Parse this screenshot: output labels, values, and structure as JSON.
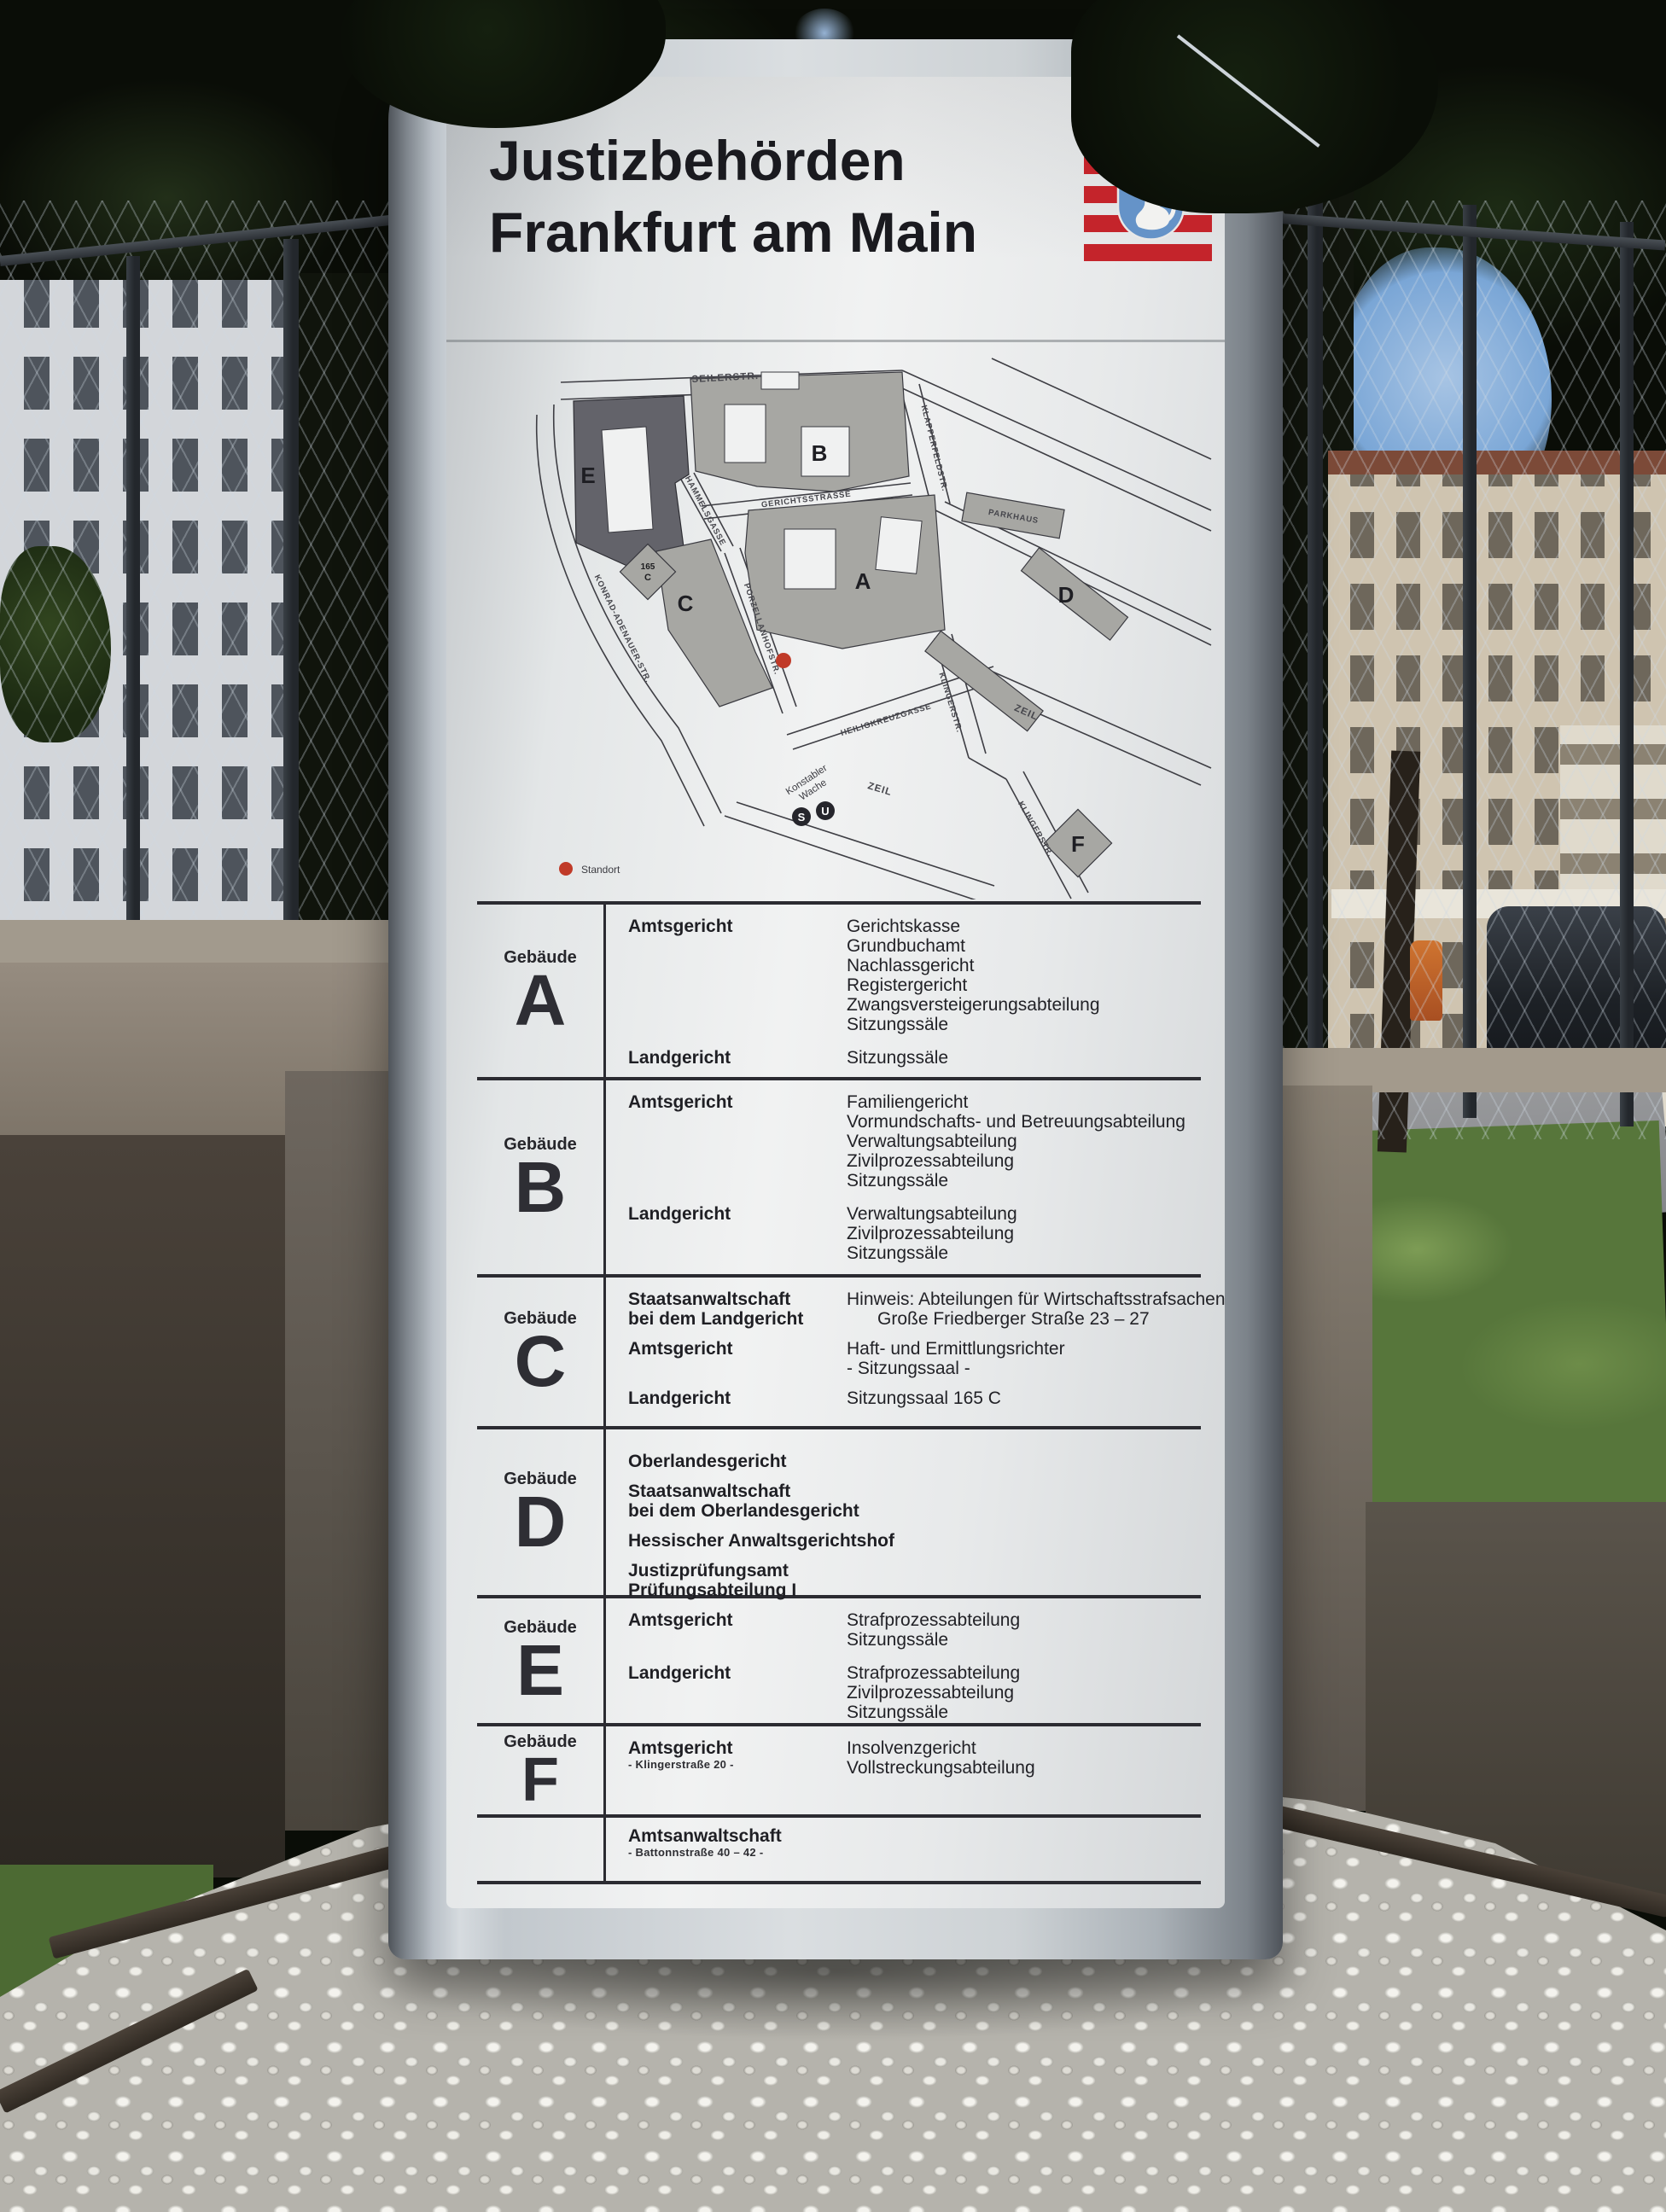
{
  "sign": {
    "title_line1": "Justizbehörden",
    "title_line2": "Frankfurt am Main",
    "hessen_label": "HESSEN",
    "colors": {
      "flag_red": "#c4242b",
      "shield_blue": "#6593c8"
    }
  },
  "map": {
    "streets": {
      "seilerstr": "SEILERSTR.",
      "klapperfeldstr": "KLAPPERFELDSTR.",
      "gerichtsstrasse": "GERICHTSSTRASSE",
      "hammelsgasse": "HAMMELSGASSE",
      "porzellanhofstr": "PORZELLANHOFSTR.",
      "konrad_adenauer_str": "KONRAD-ADENAUER-STR.",
      "heiligkreuzgasse": "HEILIGKREUZGASSE",
      "klingerstr_1": "KLINGERSTR.",
      "klingerstr_2": "KLINGERSTR.",
      "zeil_1": "ZEIL",
      "zeil_2": "ZEIL",
      "parkhaus": "PARKHAUS"
    },
    "buildings": {
      "a": "A",
      "b": "B",
      "c": "C",
      "d": "D",
      "e": "E",
      "f": "F",
      "c_annex_l1": "165",
      "c_annex_l2": "C"
    },
    "station": {
      "line1": "Konstabler",
      "line2": "Wache",
      "s": "S",
      "u": "U"
    },
    "legend": {
      "standort": "Standort"
    }
  },
  "directory": {
    "gebaeude_label": "Gebäude",
    "rows": [
      {
        "letter": "A",
        "sections": [
          {
            "org_lines": [
              "Amtsgericht"
            ],
            "items": [
              "Gerichtskasse",
              "Grundbuchamt",
              "Nachlassgericht",
              "Registergericht",
              "Zwangsversteigerungsabteilung",
              "Sitzungssäle"
            ]
          },
          {
            "org_lines": [
              "Landgericht"
            ],
            "items": [
              "Sitzungssäle"
            ]
          }
        ]
      },
      {
        "letter": "B",
        "sections": [
          {
            "org_lines": [
              "Amtsgericht"
            ],
            "items": [
              "Familiengericht",
              "Vormundschafts- und Betreuungsabteilung",
              "Verwaltungsabteilung",
              "Zivilprozessabteilung",
              "Sitzungssäle"
            ]
          },
          {
            "org_lines": [
              "Landgericht"
            ],
            "items": [
              "Verwaltungsabteilung",
              "Zivilprozessabteilung",
              "Sitzungssäle"
            ]
          }
        ]
      },
      {
        "letter": "C",
        "sections": [
          {
            "org_lines": [
              "Staatsanwaltschaft",
              "bei dem Landgericht"
            ],
            "items": [
              "Hinweis: Abteilungen für Wirtschaftsstrafsachen",
              "Große Friedberger Straße 23 – 27"
            ]
          },
          {
            "org_lines": [
              "Amtsgericht"
            ],
            "items": [
              "Haft- und Ermittlungsrichter",
              "- Sitzungssaal -"
            ]
          },
          {
            "org_lines": [
              "Landgericht"
            ],
            "items": [
              "Sitzungssaal 165 C"
            ]
          }
        ]
      },
      {
        "letter": "D",
        "sections": [
          {
            "org_lines": [
              "Oberlandesgericht"
            ]
          },
          {
            "org_lines": [
              "Staatsanwaltschaft",
              "bei dem Oberlandesgericht"
            ]
          },
          {
            "org_lines": [
              "Hessischer Anwaltsgerichtshof"
            ]
          },
          {
            "org_lines": [
              "Justizprüfungsamt",
              "Prüfungsabteilung I"
            ]
          }
        ]
      },
      {
        "letter": "E",
        "sections": [
          {
            "org_lines": [
              "Amtsgericht"
            ],
            "items": [
              "Strafprozessabteilung",
              "Sitzungssäle"
            ]
          },
          {
            "org_lines": [
              "Landgericht"
            ],
            "items": [
              "Strafprozessabteilung",
              "Zivilprozessabteilung",
              "Sitzungssäle"
            ]
          }
        ]
      },
      {
        "letter": "F",
        "sections": [
          {
            "org_lines": [
              "Amtsgericht"
            ],
            "org_sub": "- Klingerstraße 20 -",
            "items": [
              "Insolvenzgericht",
              "Vollstreckungsabteilung"
            ]
          }
        ]
      },
      {
        "letter": "",
        "sections": [
          {
            "org_lines": [
              "Amtsanwaltschaft"
            ],
            "org_sub": "- Battonnstraße 40 – 42 -"
          }
        ]
      }
    ]
  }
}
